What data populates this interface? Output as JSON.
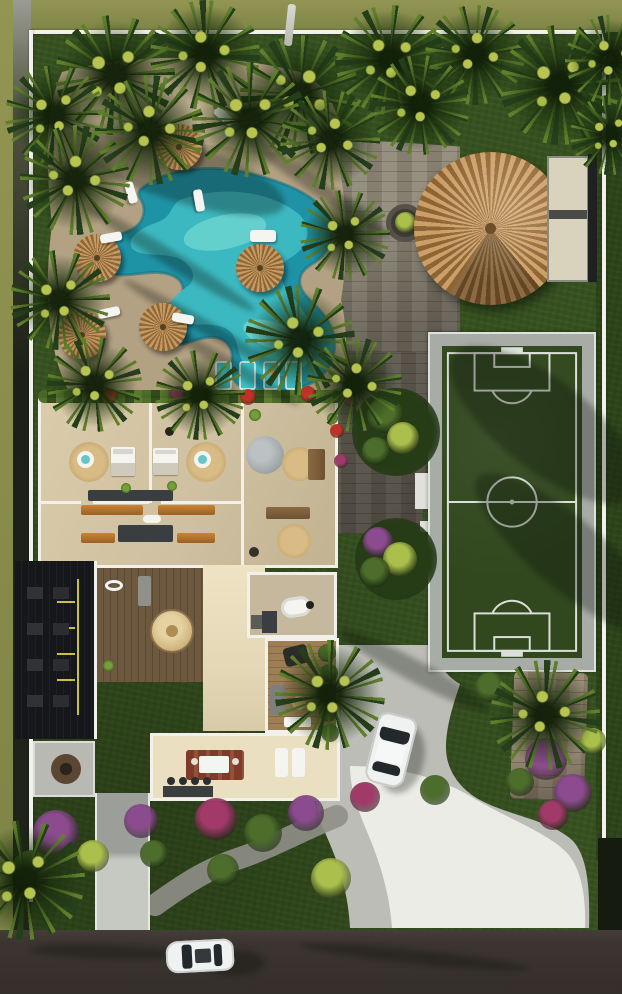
{
  "meta": {
    "title": "Tropical villa estate — aerial site plan render",
    "view": "top-down 3D architectural visualization",
    "no_text_in_image": true
  },
  "scene": {
    "setting": "Top-down aerial render of a tropical villa property with lagoon pool, palapa, soccer pitch, gardens, driveway and street",
    "features": [
      "free-form lagoon swimming pool with in-water sun-shelf loungers",
      "sand-colored pool deck with thatched palm umbrellas and white loungers",
      "large round thatched palapa pavilion with side deck",
      "walled five-a-side soccer pitch with white markings",
      "flat-roof villa cutaway showing bedrooms, kitchen, bath and terraces",
      "dark slatted pergola dining area",
      "central wood deck with round daybed",
      "curved concrete driveway with parked white car",
      "asphalt street with passing white car",
      "palm trees, bougainvillea and flowering shrubs"
    ],
    "counts": {
      "cars": 2,
      "thatched_umbrellas": 5,
      "pool_shelf_loungers": 4,
      "soccer_fields": 1,
      "palapas": 1
    }
  },
  "palette": {
    "lawn": "#36511f",
    "lawn_dark": "#263c16",
    "grass_outer": "#939552",
    "canopy": "#24401a",
    "frond": "#5f7f2c",
    "frond_light": "#b7c44f",
    "deck_sand": "#b2a183",
    "deck_sand_light": "#cdbd9e",
    "pool_deep": "#1f93a6",
    "pool_mid": "#3fbcc3",
    "pool_light": "#8ce8dc",
    "thatch_a": "#c79a63",
    "thatch_b": "#8f6736",
    "palapa_a": "#cc9f68",
    "palapa_b": "#8d6434",
    "plaza_a": "#979081",
    "plaza_b": "#867e6f",
    "field_green": "#31471e",
    "field_line": "#eceeea",
    "field_frame": "#a8aca7",
    "wall_white": "#f1f0ea",
    "floor": "#cec0a2",
    "floor_light": "#eadfc0",
    "wood_deck_a": "#6d5940",
    "wood_deck_b": "#5c4933",
    "wood_terr_a": "#9d7e55",
    "wood_terr_b": "#886a45",
    "pergola_dark": "#16171a",
    "pergola_yellow": "#c8c240",
    "drive": "#bcbdb6",
    "drive_bright": "#edeee8",
    "road": "#3b3431",
    "car_body": "#f0f2f2",
    "glass_dark": "#23282c",
    "rug_red": "#7d3b28",
    "bench_orange": "#b5752e",
    "counter_dark": "#3b3e40",
    "jute": "#c8a874",
    "stone": "#9fa5a6",
    "flower_purple": "#8c4b8e",
    "flower_magenta": "#a13a69",
    "flower_red": "#c23127",
    "shrub_green": "#4c6d2b",
    "shrub_yellow": "#aabf4c",
    "white": "#f4f5f0",
    "shadow": "rgba(8,12,5,0.3)"
  }
}
